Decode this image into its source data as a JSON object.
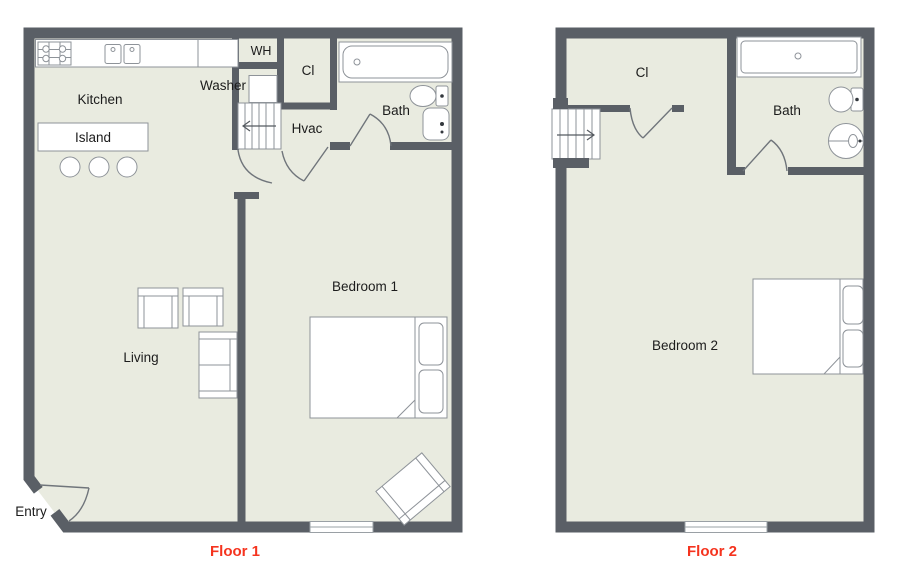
{
  "colors": {
    "wall": "#5a5f66",
    "floor": "#e9ebe0",
    "caption": "#f5341f",
    "fixture_stroke": "#8e9399"
  },
  "floors": [
    {
      "caption": "Floor 1",
      "labels": {
        "kitchen": "Kitchen",
        "island": "Island",
        "washer": "Washer",
        "water_heater": "WH",
        "closet": "Cl",
        "hvac": "Hvac",
        "bath": "Bath",
        "bedroom": "Bedroom 1",
        "living": "Living",
        "entry": "Entry"
      }
    },
    {
      "caption": "Floor 2",
      "labels": {
        "closet": "Cl",
        "bath": "Bath",
        "bedroom": "Bedroom 2"
      }
    }
  ]
}
